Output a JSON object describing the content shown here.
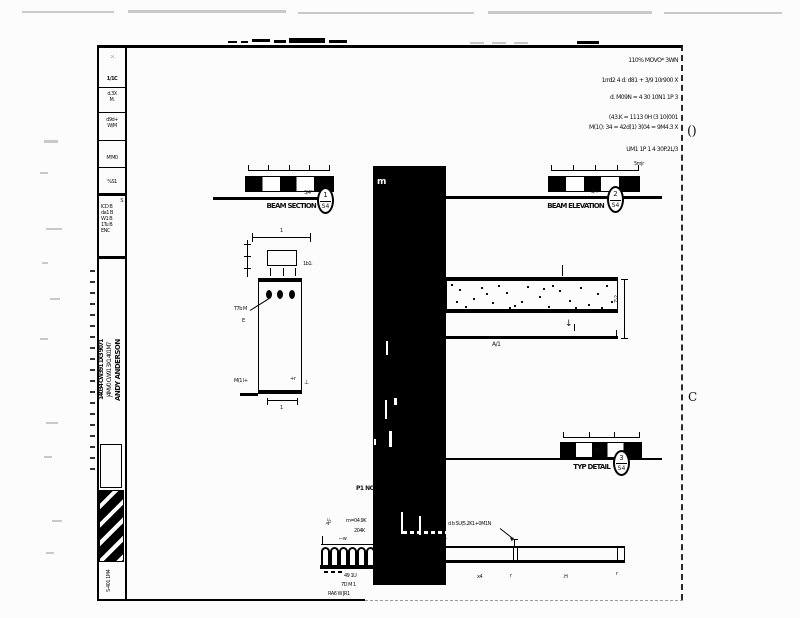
{
  "margin": {
    "corner_top": "()",
    "corner_bottom": "C"
  },
  "notes": {
    "lines": [
      "110% MOVO* 3WN",
      "1rrd2 4 d. d81 + 3/9 10r900 X",
      "d. M09N = 4 30 10N1 1P 3",
      "(43.K = 1113 0H (3 10(001",
      "M(1(): 34 = 42d(1) 3(04 = 9M4.3 X",
      "UM1 1P 1 4 30P.2L/3"
    ]
  },
  "title_block": {
    "cells": [
      [
        ":·:",
        "1/1C"
      ],
      [
        "d.3X",
        "M."
      ],
      [
        "d9d+",
        "W/M"
      ],
      [
        "M'M0"
      ],
      [
        "%S1"
      ],
      [
        "S",
        "ICD B",
        "da1 B",
        "W1 B",
        "1Tu B",
        "ENC"
      ]
    ],
    "firm_col_a": "14034 CW391 1X3 9071",
    "firm_col_b": "J4MV0 CW91 3X1 401M7",
    "firm_name": "ANDY ANDERSON",
    "stamp_text": "S-401 1M4"
  },
  "scale1": {
    "label": "BEAM SECTION",
    "scale_note": "3/4\"",
    "callout_top": "1",
    "callout_bottom": "S4"
  },
  "scale2": {
    "label": "BEAM ELEVATION",
    "scale_note": "3/4\"",
    "corner_note": "5m|r",
    "callout_top": "2",
    "callout_bottom": "S4"
  },
  "scale3": {
    "label": "TYP DETAIL",
    "scale_note": "7tu-3",
    "callout_top": "3",
    "callout_bottom": "S4"
  },
  "section": {
    "top_note": "1",
    "dim_note": "1b1:",
    "note_a": "T7b M",
    "note_b": "E",
    "note_c": "M(1 l+",
    "note_d": "+r",
    "note_e": "⊥",
    "bottom_note": "1"
  },
  "elevation": {
    "dim_text": "7'-2",
    "label": "A/1",
    "arrow": "↓"
  },
  "black_area": {
    "glyph": "m"
  },
  "bottom": {
    "ph": "P1 NC",
    "note1": "m=04.9K",
    "note2": "204K",
    "vert_note": "4½",
    "hook_note": "⌐w",
    "leader_note": "d b SU(5.2K1+0M1N",
    "tick_labels": [
      "x4",
      "r",
      ".H",
      "r"
    ],
    "under1": "49 1U",
    "under2": "7D M 1",
    "under3": "RA6 W JR1"
  }
}
